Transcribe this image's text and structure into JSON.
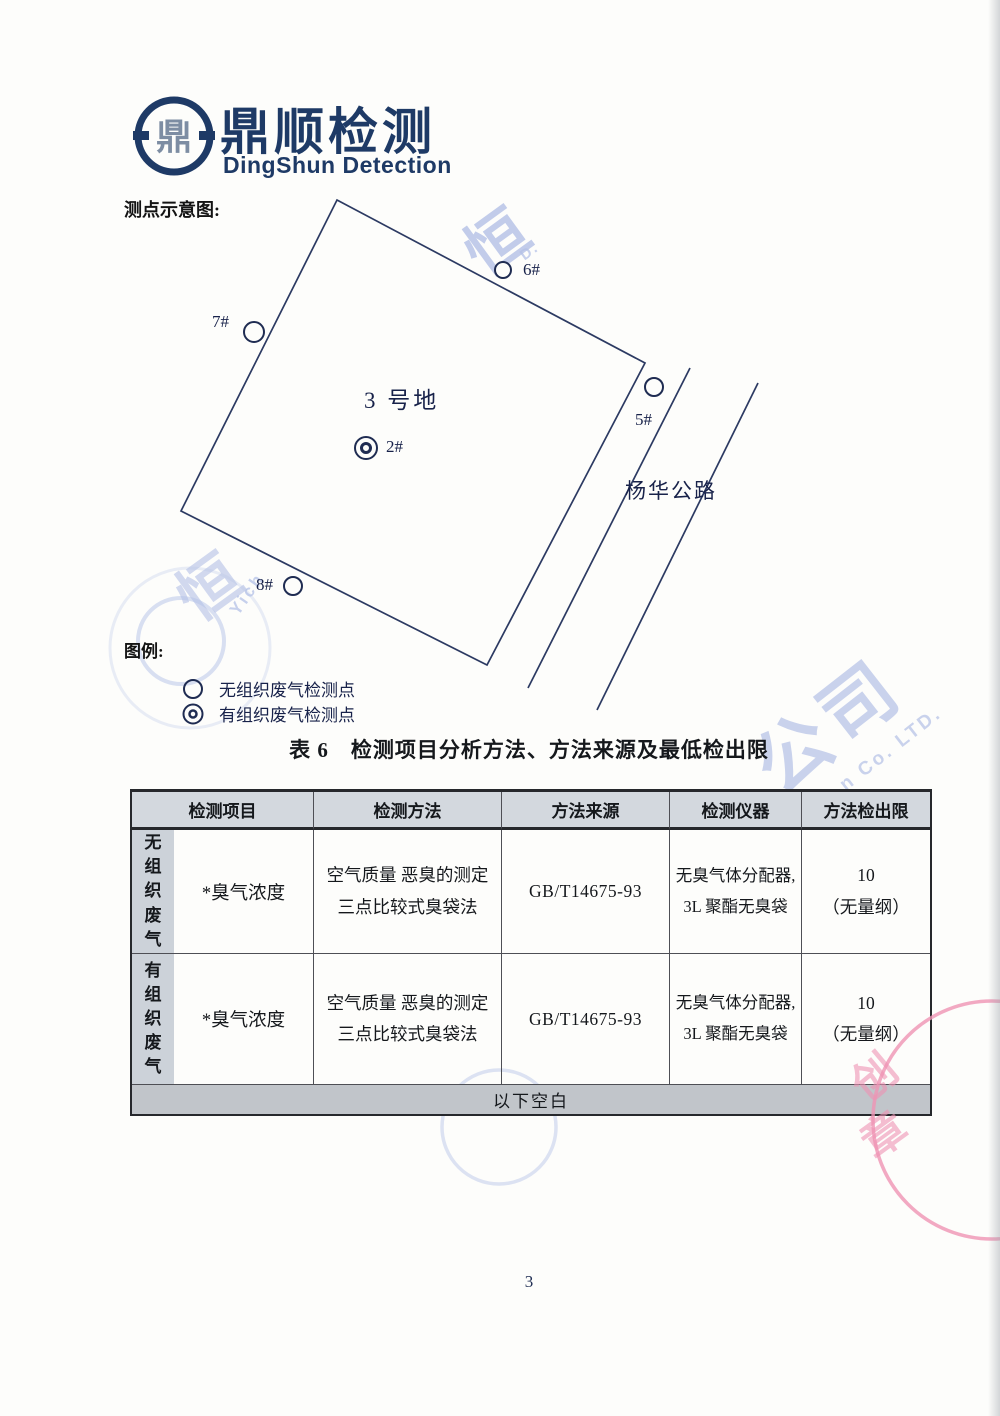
{
  "page": {
    "number": "3"
  },
  "brand": {
    "logo_zh": "鼎顺检测",
    "logo_en": "DingShun Detection",
    "emblem_glyph": "鼎",
    "color": "#1e3a66"
  },
  "diagram": {
    "section_label": "测点示意图:",
    "site_label": "3 号地",
    "road_label": "杨华公路",
    "points": {
      "p2": "2#",
      "p5": "5#",
      "p6": "6#",
      "p7": "7#",
      "p8": "8#"
    }
  },
  "legend": {
    "title": "图例:",
    "items": [
      {
        "symbol": "single-circle",
        "label": "无组织废气检测点"
      },
      {
        "symbol": "double-circle",
        "label": "有组织废气检测点"
      }
    ]
  },
  "table": {
    "title": "表 6　检测项目分析方法、方法来源及最低检出限",
    "headers": [
      "检测项目",
      "检测方法",
      "方法来源",
      "检测仪器",
      "方法检出限"
    ],
    "rows": [
      {
        "category": "无组织废气",
        "item": "*臭气浓度",
        "method_line1": "空气质量 恶臭的测定",
        "method_line2": "三点比较式臭袋法",
        "source": "GB/T14675-93",
        "instrument_line1": "无臭气体分配器,",
        "instrument_line2": "3L 聚酯无臭袋",
        "limit_line1": "10",
        "limit_line2": "（无量纲）"
      },
      {
        "category": "有组织废气",
        "item": "*臭气浓度",
        "method_line1": "空气质量 恶臭的测定",
        "method_line2": "三点比较式臭袋法",
        "source": "GB/T14675-93",
        "instrument_line1": "无臭气体分配器,",
        "instrument_line2": "3L 聚酯无臭袋",
        "limit_line1": "10",
        "limit_line2": "（无量纲）"
      }
    ],
    "footer": "以下空白",
    "header_bg": "#d3d8de",
    "label_bg": "#ccd2d9",
    "footer_bg": "#c1c5ca"
  },
  "watermark": {
    "blue_color": "#b4c1e7",
    "pink_color": "#ef93b4",
    "char_top": "恒",
    "en_top": "D.",
    "char_left": "恒",
    "en_left": "Yich",
    "chars_right": "公司",
    "en_right": "n Co. LTD.",
    "pink_char_1": "创",
    "pink_char_2": "章"
  }
}
